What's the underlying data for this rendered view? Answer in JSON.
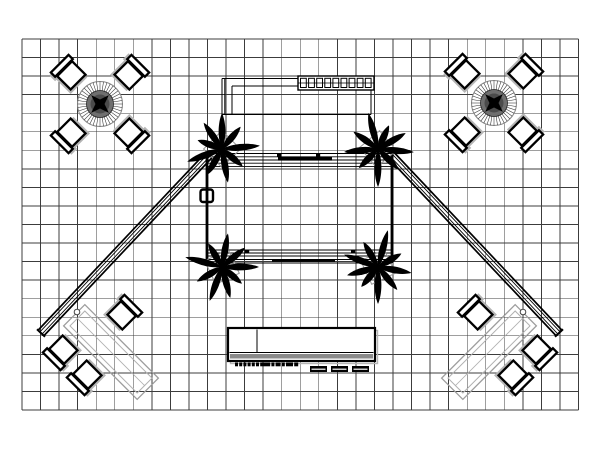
{
  "document": {
    "type": "cad-floor-plan",
    "description": "Black and white trade show booth floor plan drawn on grid paper, top view",
    "background": "#ffffff"
  },
  "colors": {
    "ink": "#000000",
    "grid": "#3c3c3c",
    "shadow": "#b5b5b5",
    "light_outline": "#9d9d9d",
    "lighter_outline": "#b0b0b0",
    "mid_gray": "#8a8a8a",
    "table_fill": "#6f6f6f",
    "table_inner": "#4b4b4b"
  },
  "grid": {
    "x": 22,
    "y": 39,
    "cols": 30,
    "rows": 20,
    "cell": 18.55,
    "stroke_width": 0.85
  },
  "conference_sets": [
    {
      "cx": 100,
      "cy": 104
    },
    {
      "cx": 494,
      "cy": 103
    }
  ],
  "conference_symbol": {
    "table_radius": 22.5,
    "hatch_inner_radius": 13.5,
    "hatch_count": 40,
    "chair_offset": 41,
    "chair_angles": [
      45,
      135,
      225,
      315
    ],
    "star_radius": 12.5
  },
  "chair_symbol": {
    "seat_w": 21,
    "seat_h": 19,
    "back_w": 25,
    "back_h": 6
  },
  "plants": [
    {
      "cx": 222,
      "cy": 149,
      "rot": 0
    },
    {
      "cx": 378,
      "cy": 149,
      "rot": 95
    },
    {
      "cx": 222,
      "cy": 267,
      "rot": 200
    },
    {
      "cx": 378,
      "cy": 267,
      "rot": 290
    }
  ],
  "plant_symbol": {
    "leaf_angles": [
      0,
      40,
      85,
      130,
      170,
      210,
      250,
      290,
      325
    ],
    "leaf_lengths": [
      36,
      29,
      38,
      27,
      34,
      30,
      37,
      26,
      32
    ],
    "pot_size": 26,
    "trunk_radius": 3.2
  },
  "booth": {
    "x": 207,
    "y": 153.5,
    "width": 185,
    "height": 109.5,
    "top_lines": [
      153.5,
      156.8,
      160,
      163.2,
      166.4
    ],
    "bottom_lines": [
      250,
      253,
      256,
      259.5,
      263
    ],
    "edge_width": 2.8,
    "monitor_bar": {
      "x": 278,
      "y": 157,
      "width": 54,
      "height": 3.6
    },
    "ticks": [
      {
        "x": 277,
        "y": 154
      },
      {
        "x": 316,
        "y": 154
      },
      {
        "x": 245,
        "y": 249.5
      },
      {
        "x": 351,
        "y": 249.5
      }
    ],
    "bottom_bar": {
      "x": 272,
      "y": 259.5,
      "width": 63,
      "height": 2.4
    },
    "handle": {
      "x": 200.5,
      "y": 189.5,
      "size": 12.5
    }
  },
  "header": {
    "outer_left_x": 222,
    "double_x": 224.8,
    "inner_left_x": 232,
    "outer_top_y": 78.5,
    "inner_top_y": 86,
    "bottom_y": 114.5,
    "right_x": 371,
    "top_span_end": 299,
    "shelf": {
      "x": 298,
      "y": 76,
      "width": 76,
      "height": 14,
      "segments": 9,
      "mid_y": 83
    }
  },
  "trusses": [
    {
      "x1": 209,
      "y1": 155,
      "x2": 41,
      "y2": 333,
      "node": {
        "cx": 77,
        "cy": 312
      }
    },
    {
      "x1": 391,
      "y1": 155,
      "x2": 559,
      "y2": 333,
      "node": {
        "cx": 523,
        "cy": 312
      }
    }
  ],
  "truss_symbol": {
    "offsets": [
      -4,
      -1.5,
      1.5,
      4
    ],
    "widths": [
      1.7,
      0.9,
      0.9,
      1.7
    ],
    "cap_half": 5.5
  },
  "lounges": [
    {
      "cx": 111,
      "cy": 352,
      "mirrored": false
    },
    {
      "cx": 489,
      "cy": 352,
      "mirrored": true
    }
  ],
  "lounge_symbol": {
    "table_w": 104,
    "table_h": 30,
    "table_rot": 45,
    "inner_inset": 4.5,
    "chairs": [
      {
        "dx": 11,
        "dy": -37,
        "rot": 45
      },
      {
        "dx": -48,
        "dy": -2,
        "rot": 225
      },
      {
        "dx": -24,
        "dy": 23,
        "rot": 225
      }
    ]
  },
  "counter": {
    "x": 228,
    "y": 328,
    "width": 147,
    "height": 33,
    "divider_x": 257,
    "shelf_line_y": 352.5,
    "gray_band": {
      "x": 230,
      "y": 354,
      "width": 143,
      "height": 4.5
    },
    "label_marks": [
      3,
      3,
      3,
      3,
      3,
      3,
      10,
      3,
      5,
      3,
      7,
      4
    ],
    "label_x": 235,
    "label_y": 362.5,
    "label_gap": 1.2,
    "label_h": 3.8,
    "stool": {
      "y": 366,
      "width": 17,
      "height": 6
    },
    "stools": [
      {
        "x": 310
      },
      {
        "x": 331
      },
      {
        "x": 352
      }
    ]
  }
}
